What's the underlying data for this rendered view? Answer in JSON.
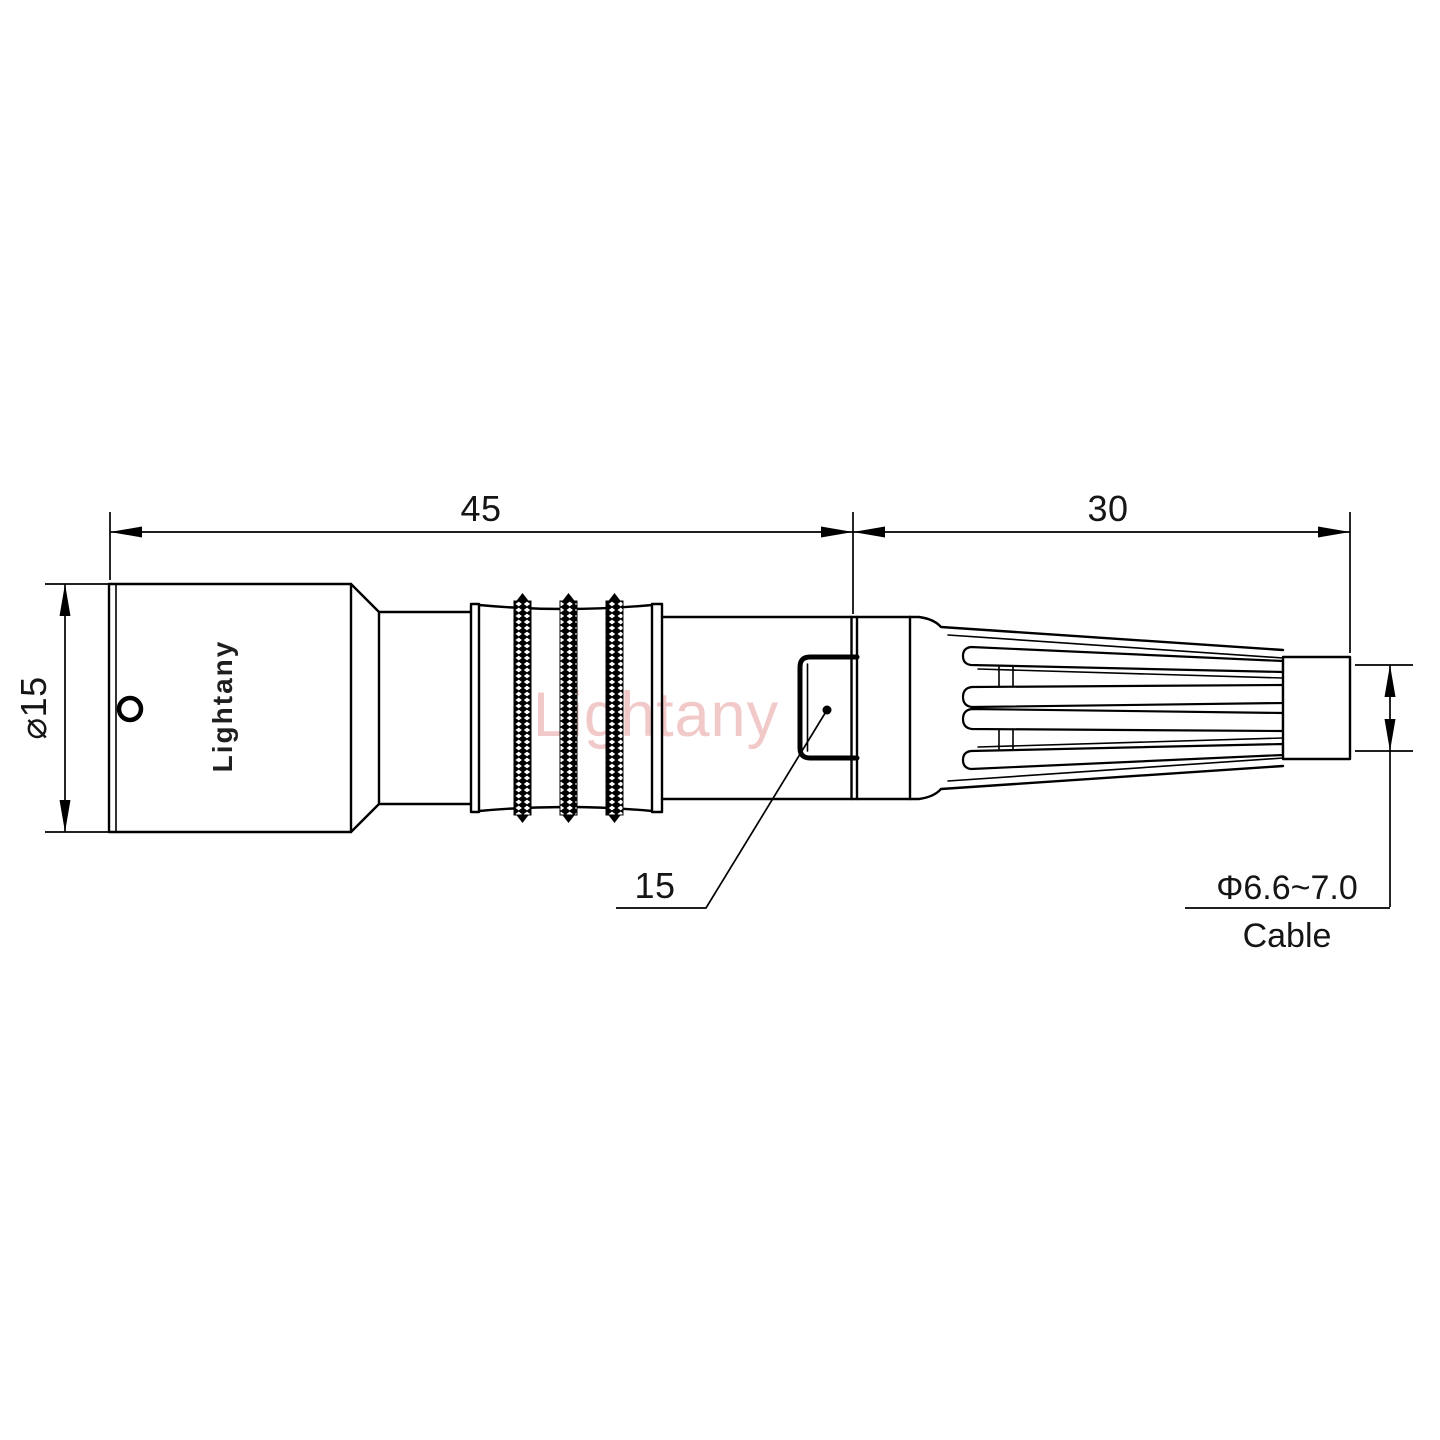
{
  "page": {
    "background_color": "#ffffff",
    "ink_color": "#000000"
  },
  "drawing": {
    "type": "engineering-dimension-drawing",
    "subject": "circular push-pull connector side view with strain relief boot",
    "brand_engraving": "Lightany",
    "watermark": {
      "text": "Lightany",
      "color": "#f2c9c9"
    },
    "dimensions": {
      "front_section_length": "45",
      "rear_section_length": "30",
      "shell_diameter": "⌀15",
      "keyway_callout": "15",
      "cable_diameter_range": "Φ6.6~7.0",
      "cable_label": "Cable"
    }
  }
}
